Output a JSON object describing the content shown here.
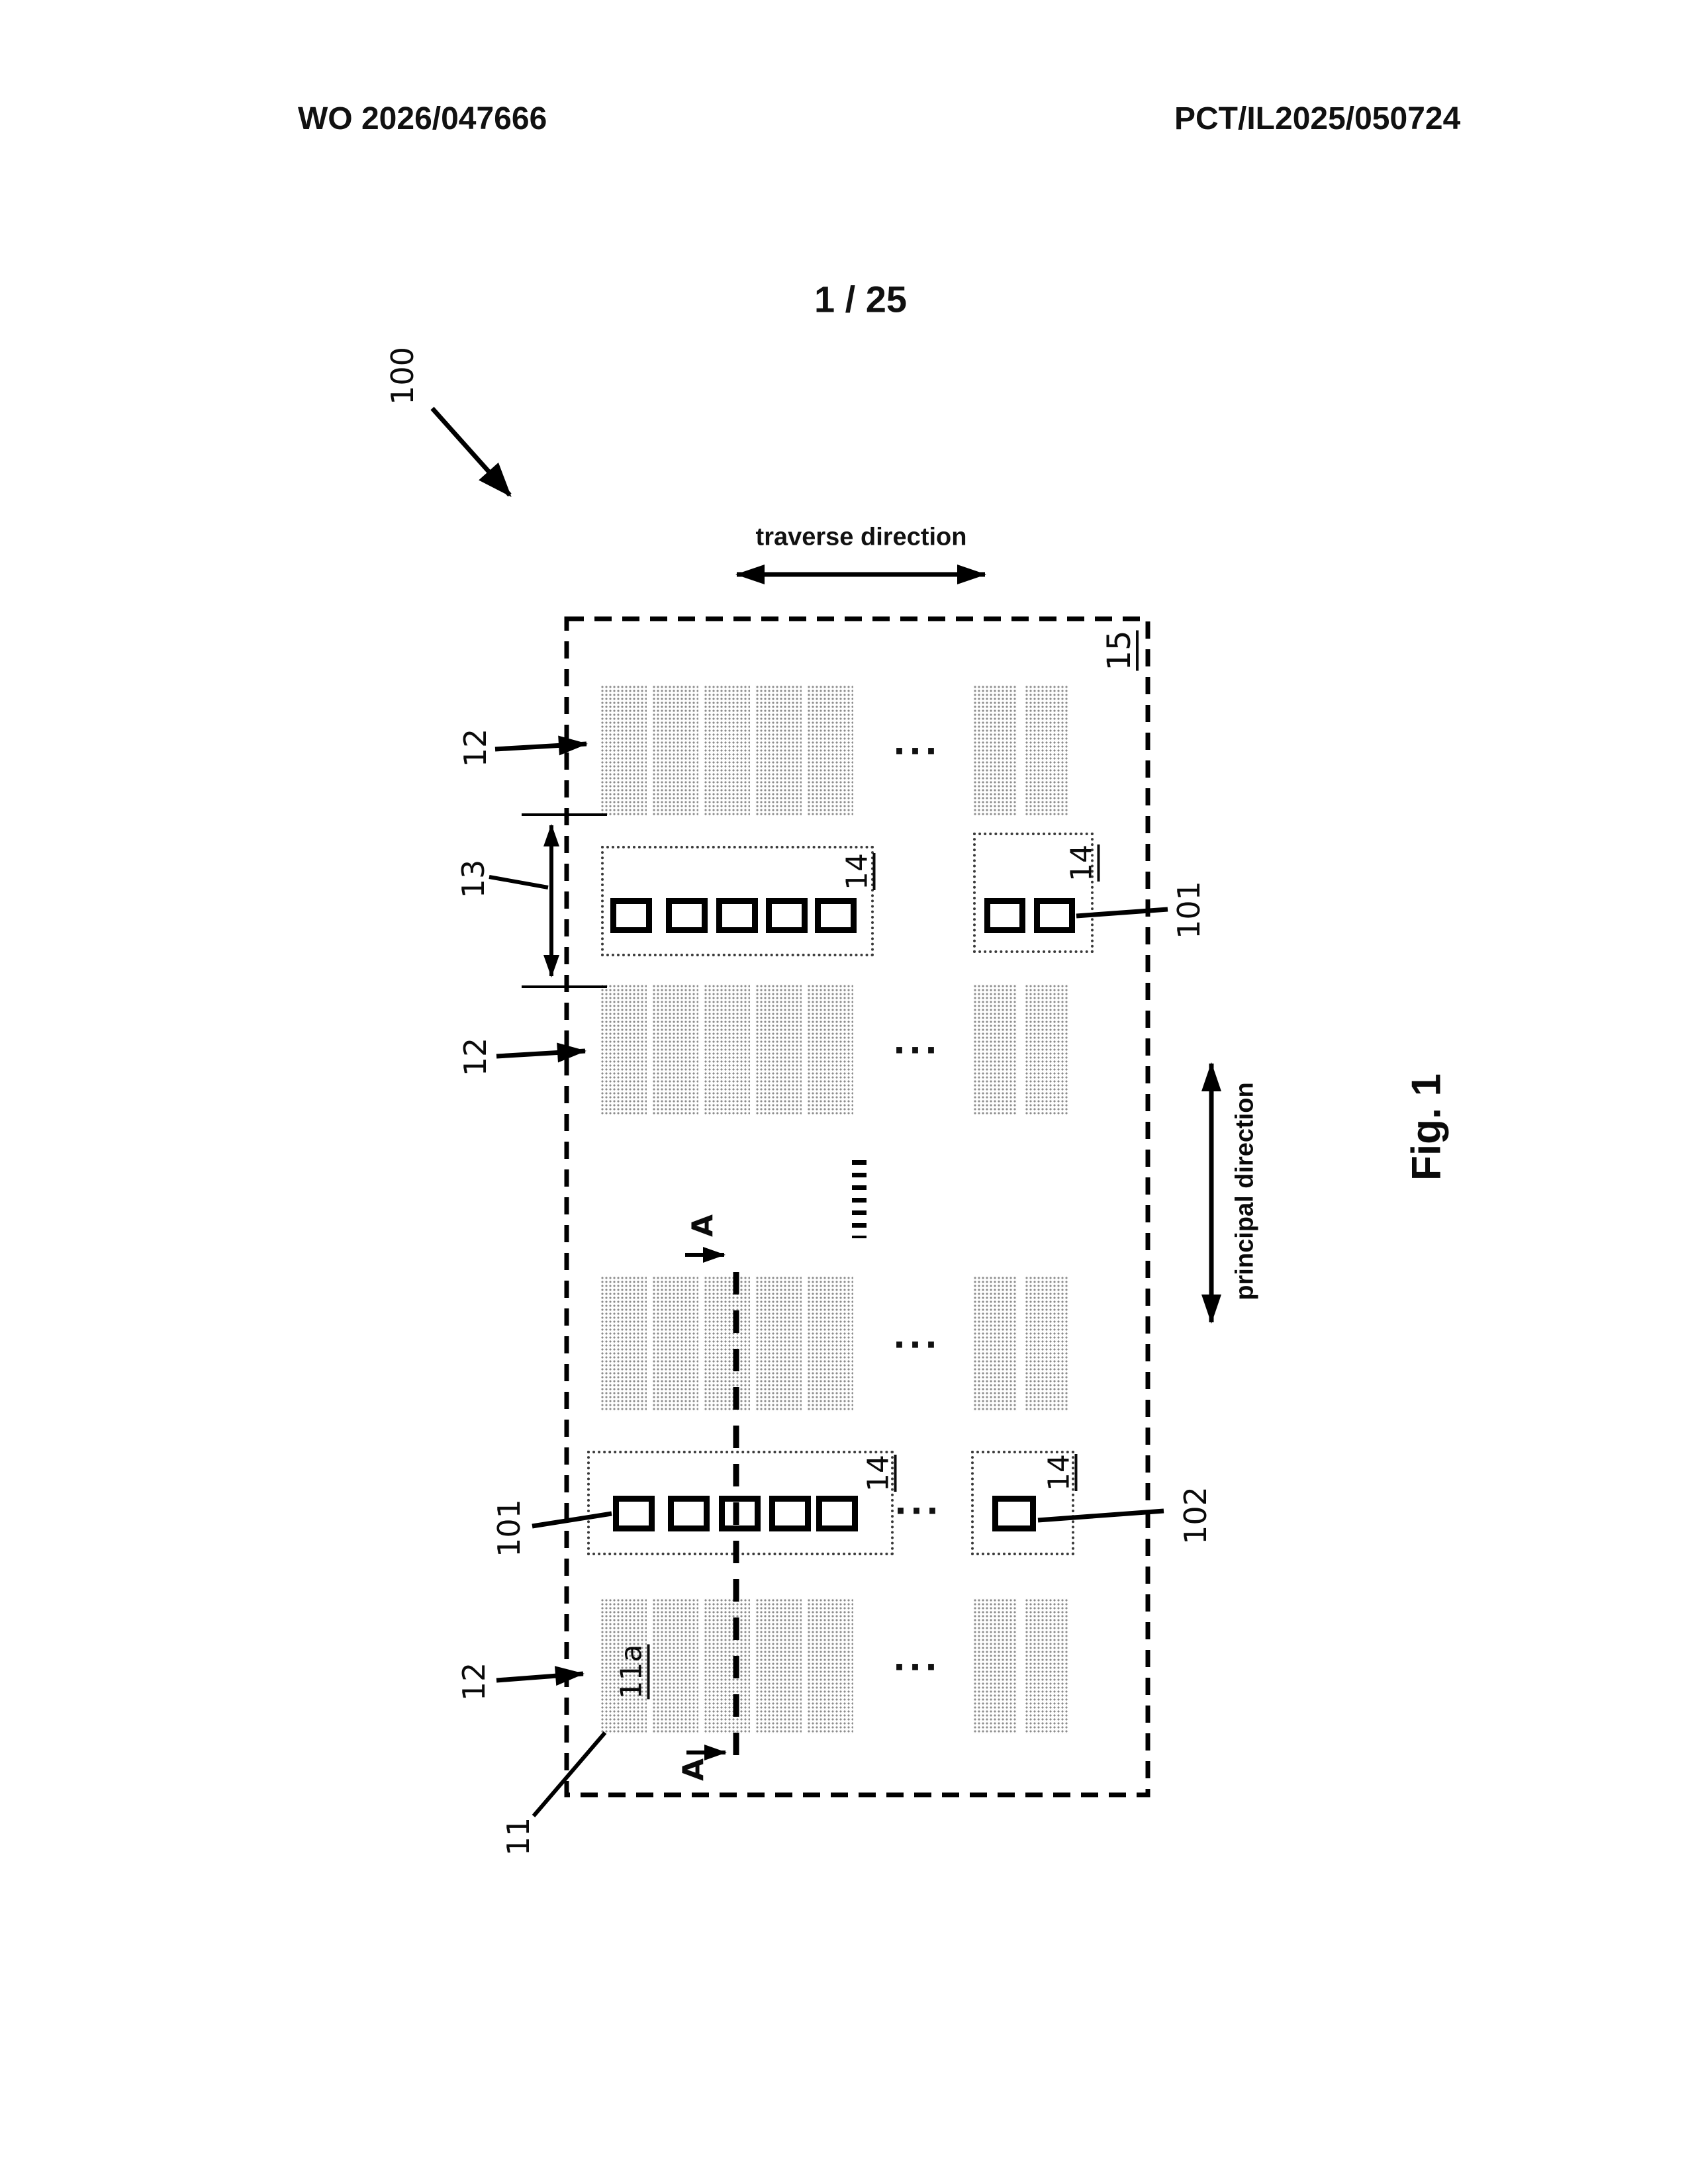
{
  "page": {
    "header_left": "WO 2026/047666",
    "header_right": "PCT/IL2025/050724",
    "sheet_number": "1 / 25",
    "figure_caption": "Fig. 1"
  },
  "directions": {
    "traverse": "traverse direction",
    "principal": "principal direction"
  },
  "reference_labels": {
    "system": "100",
    "panel": "15",
    "stripe_row": "12",
    "row_gap": "13",
    "emitter_box": "14",
    "unit_first": "101",
    "unit_second": "102",
    "substrate": "11",
    "substrate_region": "11a",
    "section": "A",
    "ellipsis": "..."
  },
  "diagram": {
    "band_count": 4,
    "left_stripe_count": 5,
    "right_stripe_count": 2,
    "box_rows": [
      {
        "left_squares": 5,
        "right_squares": 2
      },
      {
        "left_squares": 5,
        "right_squares": 1
      }
    ],
    "colors": {
      "line": "#000000",
      "hatch_dot": "#8c8c8c",
      "background": "#ffffff"
    }
  }
}
